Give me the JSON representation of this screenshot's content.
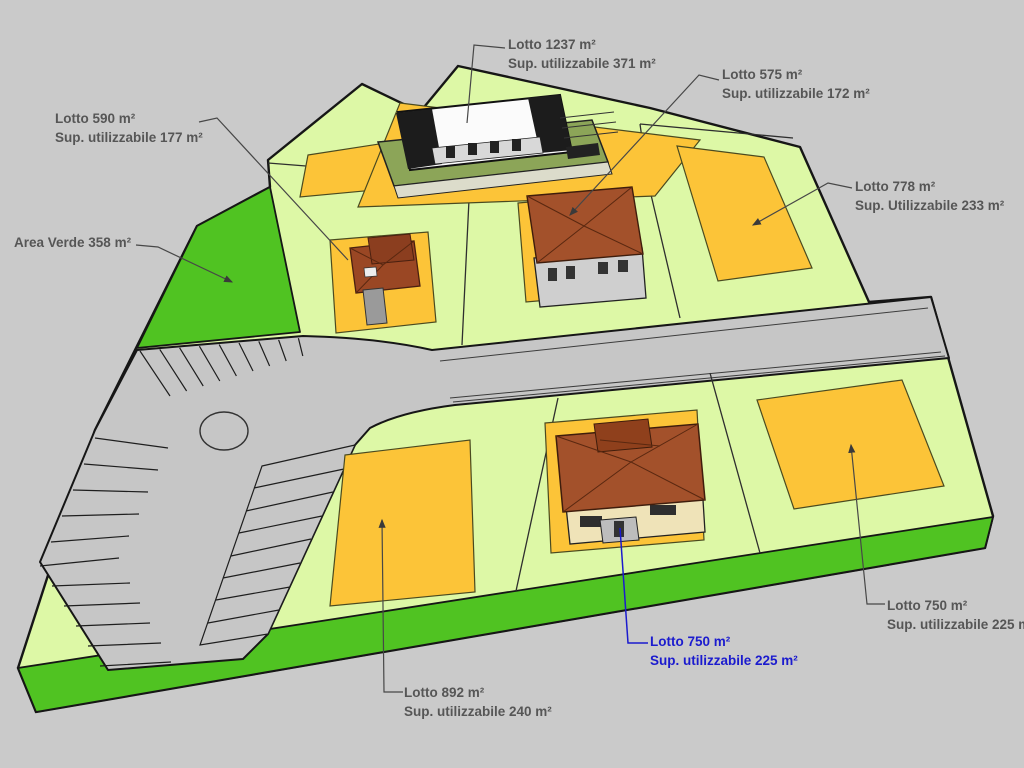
{
  "colors": {
    "background": "#CACACA",
    "site_green": "#DDF8A6",
    "area_verde": "#50C322",
    "lot_yellow": "#FCC438",
    "road_gray": "#C6C6C6",
    "outline": "#161616",
    "division": "#2E2E2E",
    "label_text": "#565656",
    "label_blue": "#1B1BCE",
    "roof_brown": "#A3512B",
    "roof_dark": "#3F1D0C",
    "wall_gray": "#CFCFCF",
    "wall_cream": "#EFE3B8",
    "pad_olive": "#8CA558",
    "building_white": "#FBFBFB",
    "building_black": "#1C1C1C"
  },
  "labels": {
    "lotto_1237": {
      "line1": "Lotto 1237 m²",
      "line2": "Sup. utilizzabile 371 m²"
    },
    "lotto_575": {
      "line1": "Lotto 575 m²",
      "line2": "Sup. utilizzabile 172 m²"
    },
    "lotto_590": {
      "line1": "Lotto 590 m²",
      "line2": "Sup. utilizzabile 177 m²"
    },
    "area_verde": {
      "line1": "Area Verde 358 m²"
    },
    "lotto_778": {
      "line1": "Lotto 778 m²",
      "line2": "Sup. Utilizzabile 233 m²"
    },
    "lotto_750_right": {
      "line1": "Lotto 750 m²",
      "line2": "Sup. utilizzabile 225 m²"
    },
    "lotto_750_blue": {
      "line1": "Lotto 750 m²",
      "line2": "Sup. utilizzabile 225 m²"
    },
    "lotto_892": {
      "line1": "Lotto 892 m²",
      "line2": "Sup. utilizzabile 240 m²"
    }
  }
}
